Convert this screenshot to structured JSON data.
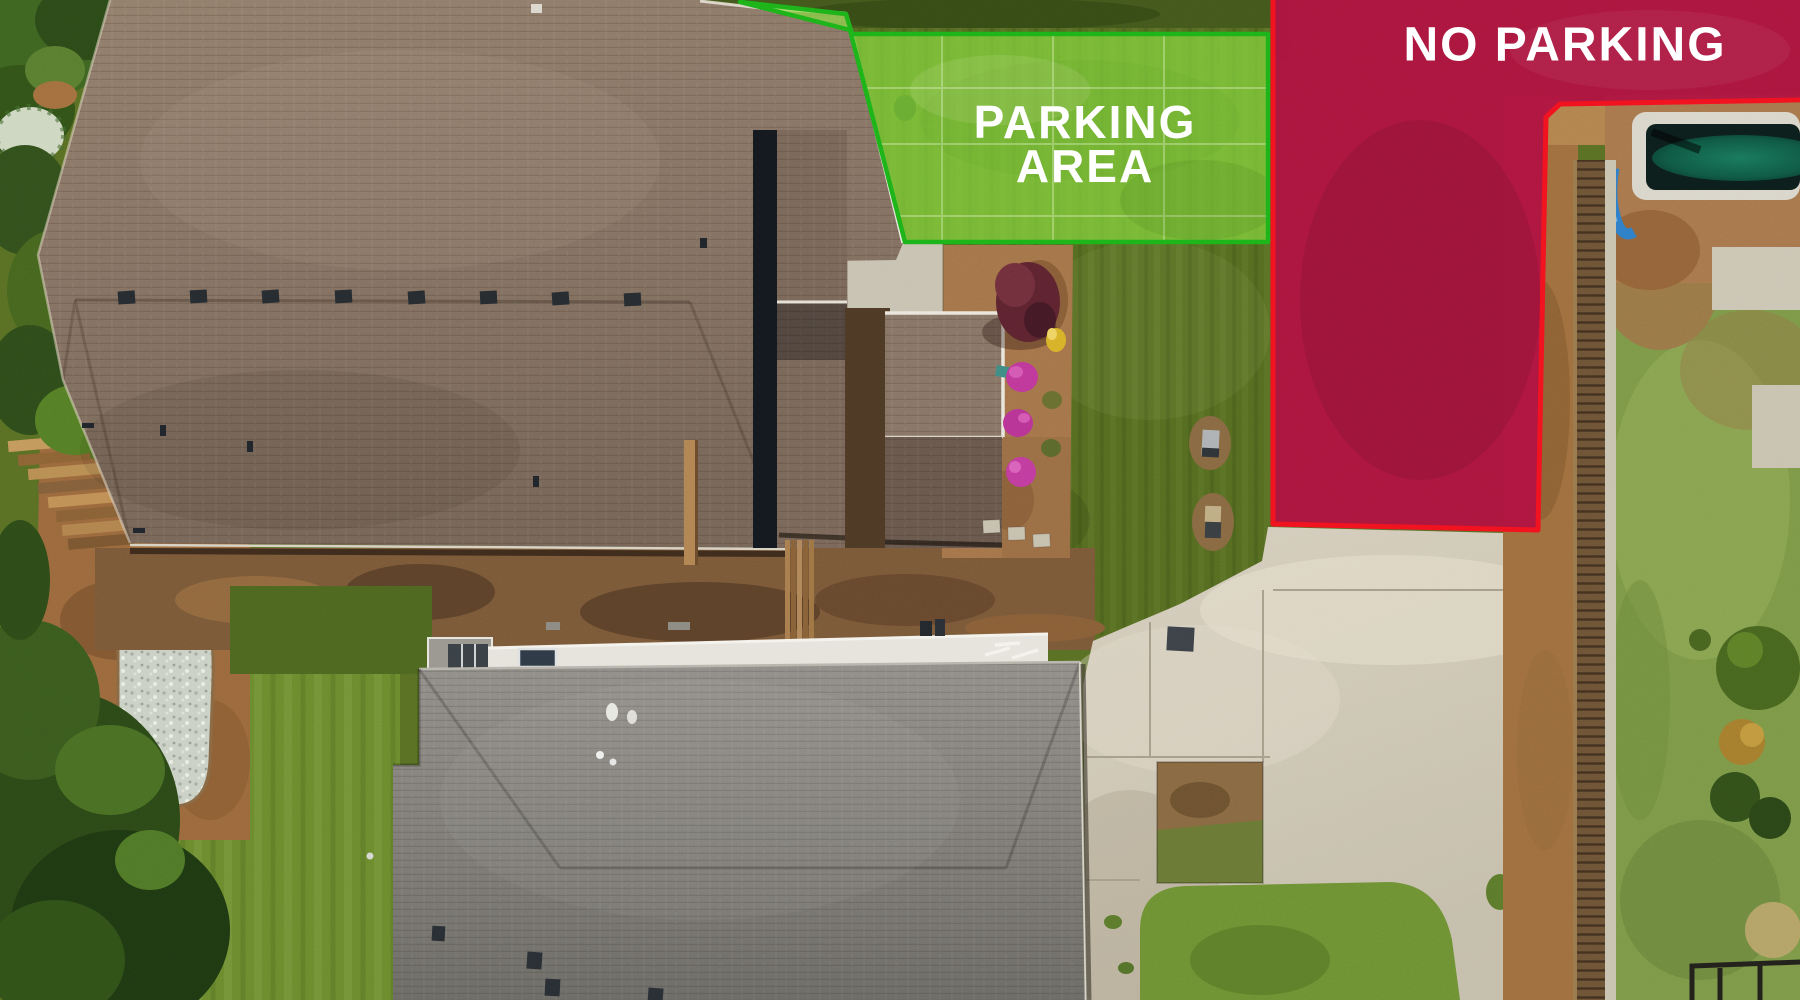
{
  "zones": {
    "parking": {
      "label_line1": "PARKING",
      "label_line2": "AREA",
      "fill_color": "#8ce141",
      "border_color": "#1db41a",
      "text_color": "#ffffff"
    },
    "no_parking": {
      "label": "NO PARKING",
      "fill_color": "#b01341",
      "border_color": "#f2121f",
      "text_color": "#ffffff"
    }
  }
}
